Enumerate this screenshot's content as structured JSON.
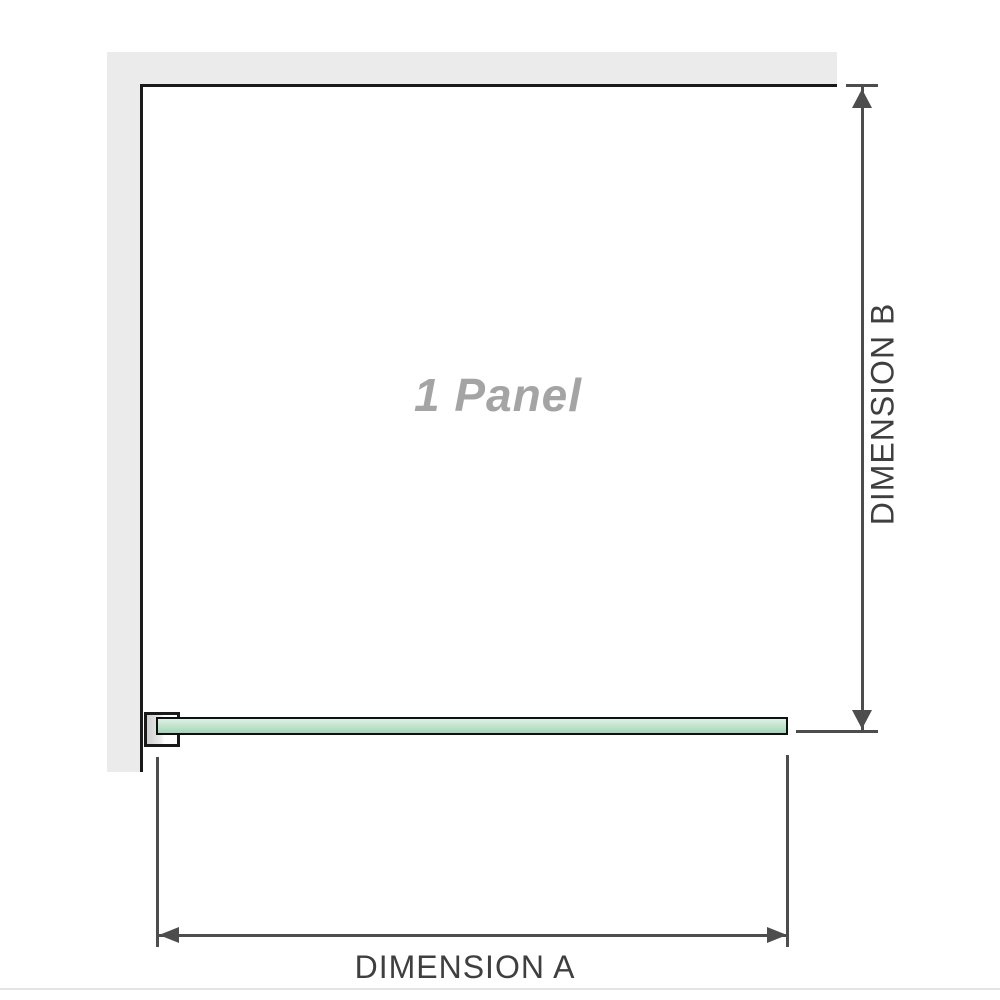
{
  "diagram": {
    "watermark": "1 Panel",
    "dimension_a": {
      "label": "DIMENSION A"
    },
    "dimension_b": {
      "label": "DIMENSION B"
    }
  },
  "colors": {
    "wall": "#ebebeb",
    "outline": "#1a1a1a",
    "dimension-line": "#4d4d4d",
    "dimension-text": "#3f3f3f",
    "watermark-text": "#a4a4a4",
    "glass-border": "#101010",
    "glass-top": "#dff2e6",
    "glass-bottom": "#a2d5b6",
    "bracket-fill": "#cfcfcf",
    "divider": "#e4e4e0"
  }
}
